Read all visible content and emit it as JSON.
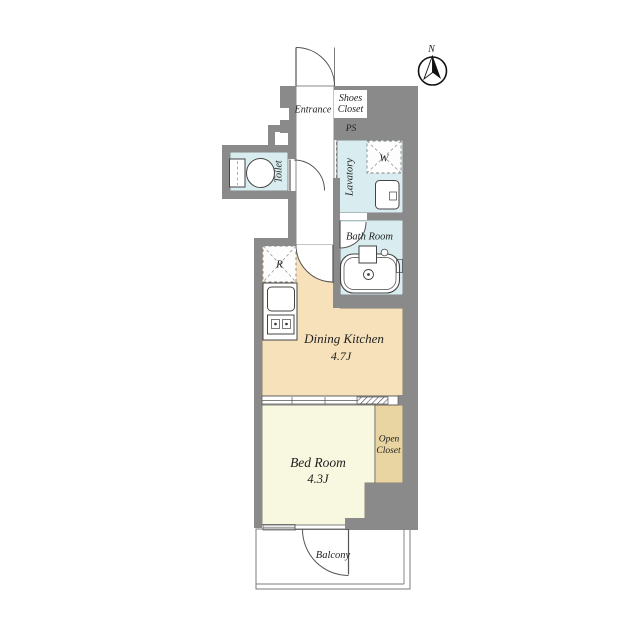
{
  "compass": {
    "north_label": "N"
  },
  "labels": {
    "entrance": "Entrance",
    "shoes_closet_line1": "Shoes",
    "shoes_closet_line2": "Closet",
    "ps": "PS",
    "toilet": "Toilet",
    "lavatory": "Lavatory",
    "washer": "W",
    "bath_room": "Bath Room",
    "fridge": "R",
    "dining_kitchen": "Dining Kitchen",
    "dining_kitchen_size": "4.7J",
    "bed_room": "Bed Room",
    "bed_room_size": "4.3J",
    "open_closet_line1": "Open",
    "open_closet_line2": "Closet",
    "balcony": "Balcony"
  },
  "colors": {
    "wall": "#8a8a8a",
    "wet_area": "#d9edf0",
    "dining_kitchen": "#f6e1ba",
    "bedroom": "#f8f7e0",
    "closet": "#e9d5a1",
    "white": "#ffffff",
    "line": "#4d4d4d",
    "background": "#ffffff"
  }
}
